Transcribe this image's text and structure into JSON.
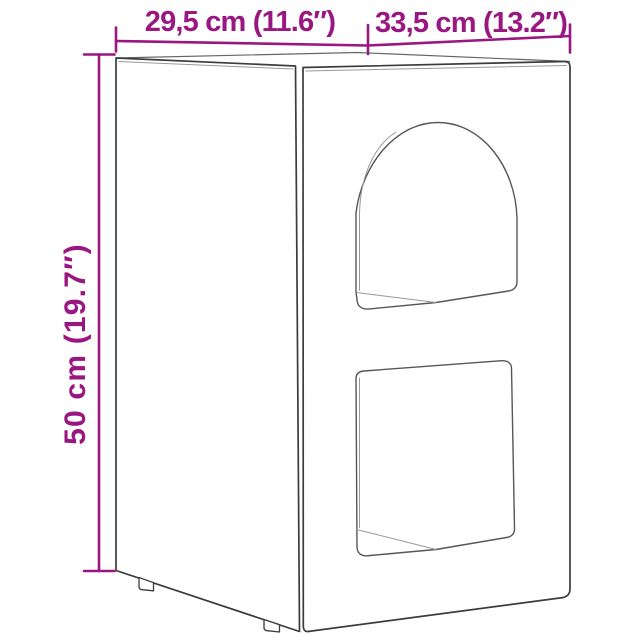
{
  "labels": {
    "top_left": "29,5 cm (11.6″)",
    "top_right": "33,5 cm (13.2″)",
    "side": "50 cm (19.7″)"
  },
  "colors": {
    "accent": "#9A1680",
    "outline": "#3C3C3C",
    "edge": "#666666",
    "opening": "#575757",
    "thin": "#999999"
  }
}
